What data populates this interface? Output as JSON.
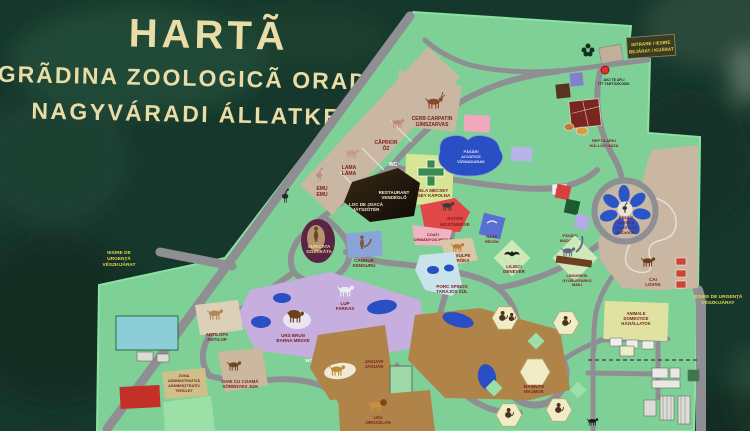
{
  "t": {
    "title1": "HARTÃ",
    "title2": "GRÃDINA ZOOLOGICÃ ORADEA",
    "title3": "NAGYVÁRADI ÁLLATKERT",
    "intrare1": "INTRARE / IESIRE",
    "intrare2": "BEJÁRAT / KIJÁRAT",
    "aici1": "AICI TE AFLI",
    "aici2": "ITT TARTÓZKODIK",
    "exitL1": "IESIRE DE",
    "exitL2": "URGENȚĂ",
    "exitL3": "VÉSZKIJÁRAT",
    "exitR1": "IESIRE DE URGENȚĂ",
    "exitR2": "VÉSZKIJÁRAT",
    "cerb1": "CERB CARPATIN",
    "cerb2": "GÍMSZARVAS",
    "caprior1": "CĂPRIOR",
    "caprior2": "ŐZ",
    "lama1": "LAMA",
    "lama2": "LÁMA",
    "emu1": "EMU",
    "emu2": "EMU",
    "rest1": "RESTAURANT",
    "rest2": "VENDÉGLŐ",
    "joaca1": "LOC DE JOACĂ",
    "joaca2": "JÁTSZÓTÉR",
    "capela1": "CAPELA MECSEY",
    "capela2": "MECSEY KÁPOLNA",
    "acva1": "PĂSĂRI",
    "acva2": "ACVATICE",
    "acva3": "VÍZIMADARAK",
    "suri1": "SURICATA",
    "suri2": "SZURIKÁTA",
    "cangur1": "CANGUR",
    "cangur2": "KENGURU",
    "raton1": "RATON",
    "raton2": "MOSÓMEDVE",
    "coati1": "COATI",
    "coati2": "ORMÁNYOS MEDVE",
    "rate1": "RAȚE",
    "rate2": "RÉCÉK",
    "vulpe1": "VULPE",
    "vulpe2": "RÓKA",
    "lilieci1": "LILIECI",
    "lilieci2": "DENEVÉR",
    "porc1": "PORC SPINOS",
    "porc2": "TARAJOS SÜL",
    "lup1": "LUP",
    "lup2": "FARKAS",
    "urs1": "URS BRUN",
    "urs2": "BARNA MEDVE",
    "anti1": "ANTILOPA",
    "anti2": "ANTILOP",
    "oaie1": "OAIE CU COAMĂ",
    "oaie2": "SÖRÉNYES JUH",
    "admin1": "ZONA",
    "admin2": "ADMINISTRATIVĂ",
    "admin3": "ADMINISZTRATÍV",
    "admin4": "TERÜLET",
    "jaguar1": "JAGUAR",
    "jaguar2": "JAGUÁR",
    "leu1": "LEU",
    "leu2": "OROSZLÁN",
    "maimute1": "MAIMUȚE",
    "maimute2": "MAJMOK",
    "dom1": "ANIMALE",
    "dom2": "DOMESTICE",
    "dom3": "HÁZIÁLLATOK",
    "cai1": "CAI",
    "cai2": "LOVAK",
    "exo1": "PĂSĂRI",
    "exo2": "EXOTICE",
    "exo3": "EGZOTIKUS",
    "exo4": "MADARAK",
    "pasari1": "PĂSĂRI",
    "pasari2": "MADARAK",
    "lemur1": "LEMURIENI",
    "lemur2": "GYŰRŰSFARKÚ",
    "lemur3": "MAKI",
    "reptil1": "REPTILARIU",
    "reptil2": "HÜLLŐK HÁZA",
    "wc": "WC"
  },
  "colors": {
    "sign_background": "#16382c",
    "map_green": "#7fd096",
    "path_gray": "#8f8f93",
    "water_blue": "#2a4ec4",
    "title_cream": "#e9dca6",
    "label_maroon": "#7c2121",
    "exit_yellow": "#e8d44a",
    "enclosure_tan": "#c9b7a3",
    "enclosure_brown": "#b08448",
    "enclosure_lavender": "#c6aede"
  }
}
